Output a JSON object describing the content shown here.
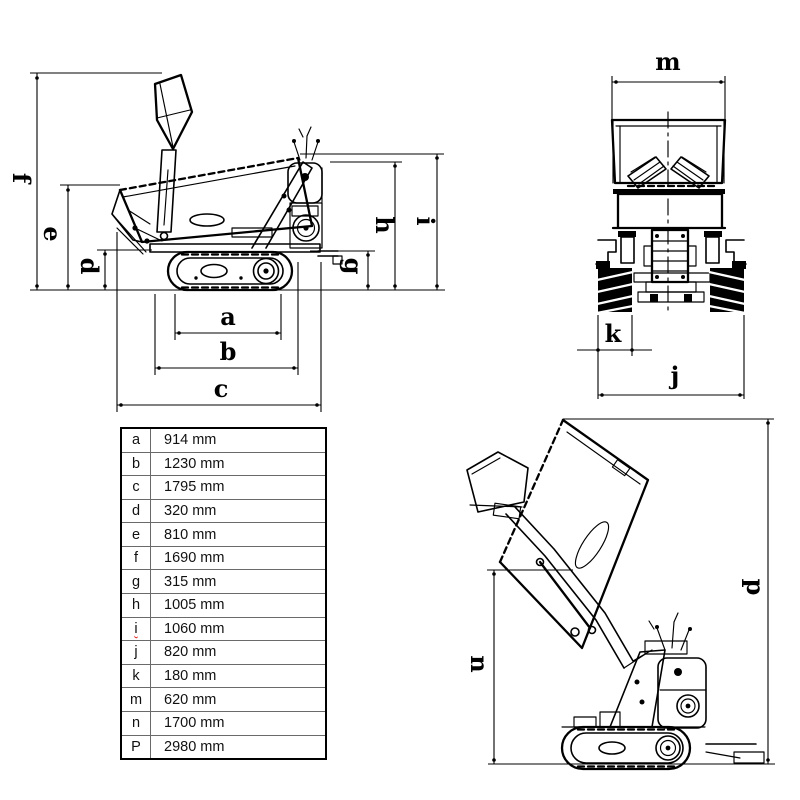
{
  "colors": {
    "background": "#ffffff",
    "line": "#000000",
    "spellcheck_underline": "#e01b1b"
  },
  "drawing_labels": {
    "a": "a",
    "b": "b",
    "c": "c",
    "d": "d",
    "e": "e",
    "f": "f",
    "g": "g",
    "h": "h",
    "i": "i",
    "j": "j",
    "k": "k",
    "m": "m",
    "n": "n",
    "p": "p"
  },
  "table": {
    "rows": [
      {
        "label": "a",
        "value": "914 mm"
      },
      {
        "label": "b",
        "value": "1230 mm"
      },
      {
        "label": "c",
        "value": "1795 mm"
      },
      {
        "label": "d",
        "value": "320 mm"
      },
      {
        "label": "e",
        "value": "810 mm"
      },
      {
        "label": "f",
        "value": "1690 mm"
      },
      {
        "label": "g",
        "value": "315 mm"
      },
      {
        "label": "h",
        "value": "1005 mm"
      },
      {
        "label": "i",
        "value": "1060 mm"
      },
      {
        "label": "j",
        "value": "820 mm"
      },
      {
        "label": "k",
        "value": "180 mm"
      },
      {
        "label": "m",
        "value": "620 mm"
      },
      {
        "label": "n",
        "value": "1700 mm"
      },
      {
        "label": "P",
        "value": "2980 mm"
      }
    ]
  }
}
